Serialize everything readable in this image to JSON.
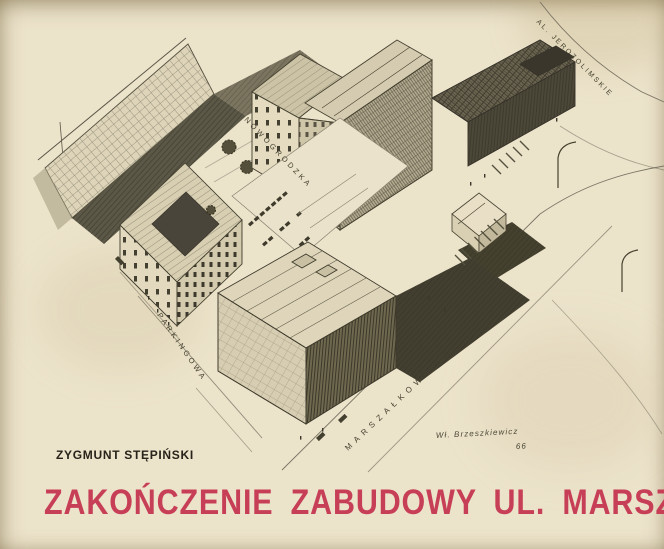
{
  "page": {
    "paper_color": "#ece3cb",
    "author": "ZYGMUNT STĘPIŃSKI",
    "title": "ZAKOŃCZENIE ZABUDOWY UL. MARSZAŁKOWSKIEJ",
    "title_color": "#c73f56"
  },
  "drawing": {
    "type": "axonometric architectural pencil sketch",
    "subject": "Completion of the development of Marszałkowska street at the Aleje Jerozolimskie intersection",
    "street_labels": {
      "nowogrodzka": "NOWOGRODZKA",
      "aleje_jerozolimskie": "AL. JEROZOLIMSKIE",
      "marszalkowska": "MARSZAŁKOWSKA",
      "parkingowa": "PARKINGOWA"
    },
    "signature": "Wł. Brzeszkiewicz",
    "signature_year": "66"
  }
}
